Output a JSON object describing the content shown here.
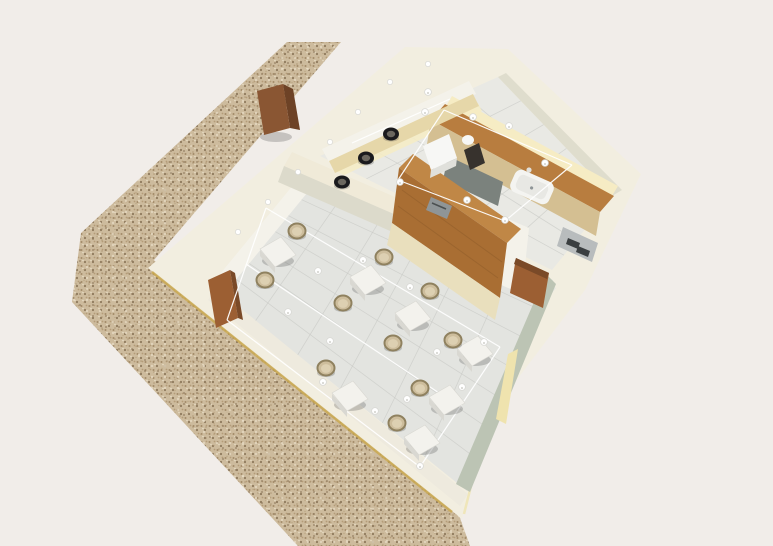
{
  "meta": {
    "title": "Aerial 3D render of a small cafe / coffee-shop interior",
    "view": "axonometric top-down 3D visualization, building rotated on a speckled sidewalk",
    "canvas": {
      "width": 773,
      "height": 546
    }
  },
  "colors": {
    "background": "#f1ede9",
    "pavement_base": "#cdbb9d",
    "speck_a": "#a28a68",
    "speck_b": "#8f7a5d",
    "speck_c": "#e9ddc6",
    "speck_d": "#b49c78",
    "shell": "#f2eee0",
    "shell_bright": "#f7f3e8",
    "gold_trim": "#c9a84c",
    "floor_dining": "#e3e4e0",
    "floor_kitchen": "#e9e9e4",
    "floor_corridor": "#e6e6e1",
    "grout": "#c8c9c5",
    "wall_face_light": "#f4f2ea",
    "wall_face_sw": "#eeeade",
    "wall_sage": "#bcc4b4",
    "wall_back_band": "#dfddcd",
    "wall_divider_top": "#f0ead8",
    "wall_divider_face": "#dcdacb",
    "glow": "#f6ecc4",
    "glow_base": "#efe3ae",
    "wood_top": "#b87d3f",
    "wood_light": "#c08746",
    "wood_face": "#a96e33",
    "wood_grain": "#8f5c2a",
    "cabinet_cream": "#e9dfbd",
    "cabinet_tan": "#d4bf92",
    "cabinet_gray": "#7b827d",
    "bar_top": "#e6d7a9",
    "door_brown": "#9c5f33",
    "door_dark": "#7a4a28",
    "sign_front": "#8a5633",
    "sign_side": "#6d4226",
    "table_top": "#f3f2ed",
    "table_side": "#d9d8d2",
    "chair_body": "#cdbd9c",
    "chair_ring": "#8f815f",
    "chair_seat": "#ddd0b2",
    "stool_dark": "#1a1a1d",
    "stool_center": "#6b675f",
    "steel": "#b8bcbd",
    "steel_dark": "#3a3e40",
    "machine_white": "#f7f7f5",
    "machine_shade": "#e0e0db",
    "grinder_dark": "#37322d",
    "register": "#8f9597",
    "sink_outer": "#f4f4f1",
    "sink_inner": "#e8e8e4",
    "wire": "#ffffff",
    "light_fill": "#ffffff",
    "light_stroke": "#d8d8d4",
    "shadow": "rgba(40,40,40,0.22)"
  },
  "scene": {
    "pavement": {
      "label": "speckled terrazzo sidewalk strip running diagonally along the shop facade",
      "sign": {
        "label": "wooden A-frame sandwich board on sidewalk"
      }
    },
    "building": {
      "label": "rotated rectangular cafe building, cream outer walls seen from above",
      "rooms": [
        "kitchen / service room",
        "dining room",
        "corridor with back door"
      ]
    },
    "kitchen": {
      "label": "service room with L-shaped wooden counter",
      "equipment": [
        "espresso machine",
        "coffee grinder",
        "cash register",
        "inset sink with faucet",
        "stainless under-counter appliance",
        "window bar with stools"
      ],
      "stools": [
        [
          342,
          182
        ],
        [
          366,
          158
        ],
        [
          391,
          134
        ]
      ],
      "lights": [
        [
          428,
          92
        ],
        [
          425,
          112
        ],
        [
          473,
          117
        ],
        [
          509,
          126
        ],
        [
          545,
          163
        ],
        [
          400,
          182
        ],
        [
          467,
          200
        ],
        [
          505,
          220
        ]
      ],
      "wires": [
        [
          [
            444,
            110
          ],
          [
            572,
            165
          ]
        ],
        [
          [
            398,
            180
          ],
          [
            505,
            221
          ]
        ],
        [
          [
            444,
            110
          ],
          [
            398,
            180
          ]
        ],
        [
          [
            572,
            165
          ],
          [
            505,
            221
          ]
        ],
        [
          [
            352,
            143
          ],
          [
            450,
            99
          ]
        ]
      ]
    },
    "dining": {
      "label": "dining room with square marble tables and rattan chairs",
      "tables": [
        {
          "x": 278,
          "y": 252,
          "chairs": [
            [
              19,
              -21
            ],
            [
              -13,
              28
            ]
          ]
        },
        {
          "x": 368,
          "y": 280,
          "chairs": [
            [
              16,
              -23
            ]
          ]
        },
        {
          "x": 413,
          "y": 316,
          "chairs": [
            [
              17,
              -25
            ],
            [
              -20,
              27
            ]
          ]
        },
        {
          "x": 475,
          "y": 351,
          "chairs": [
            [
              -22,
              -11
            ]
          ]
        },
        {
          "x": 350,
          "y": 396,
          "chairs": [
            [
              -24,
              -28
            ]
          ]
        },
        {
          "x": 447,
          "y": 400,
          "chairs": [
            [
              -27,
              -12
            ]
          ]
        },
        {
          "x": 422,
          "y": 440,
          "chairs": [
            [
              -25,
              -17
            ]
          ]
        }
      ],
      "loose_chairs": [
        [
          343,
          303
        ]
      ],
      "lights": [
        [
          318,
          271
        ],
        [
          363,
          260
        ],
        [
          288,
          312
        ],
        [
          410,
          287
        ],
        [
          330,
          341
        ],
        [
          437,
          352
        ],
        [
          375,
          411
        ],
        [
          323,
          382
        ],
        [
          407,
          399
        ],
        [
          462,
          387
        ],
        [
          420,
          466
        ],
        [
          484,
          342
        ]
      ],
      "wires": [
        [
          [
            266,
            208
          ],
          [
            500,
            347
          ]
        ],
        [
          [
            227,
            320
          ],
          [
            420,
            467
          ]
        ],
        [
          [
            266,
            208
          ],
          [
            227,
            320
          ]
        ],
        [
          [
            500,
            347
          ],
          [
            420,
            467
          ]
        ],
        [
          [
            246,
            264
          ],
          [
            460,
            407
          ]
        ]
      ]
    },
    "facade_downlights": [
      [
        238,
        232
      ],
      [
        268,
        202
      ],
      [
        298,
        172
      ],
      [
        330,
        142
      ],
      [
        358,
        112
      ],
      [
        390,
        82
      ],
      [
        428,
        64
      ]
    ],
    "counts": {
      "dining_tables": 7,
      "dining_chairs": 10,
      "bar_stools": 3,
      "pendant_lights": 20
    }
  }
}
